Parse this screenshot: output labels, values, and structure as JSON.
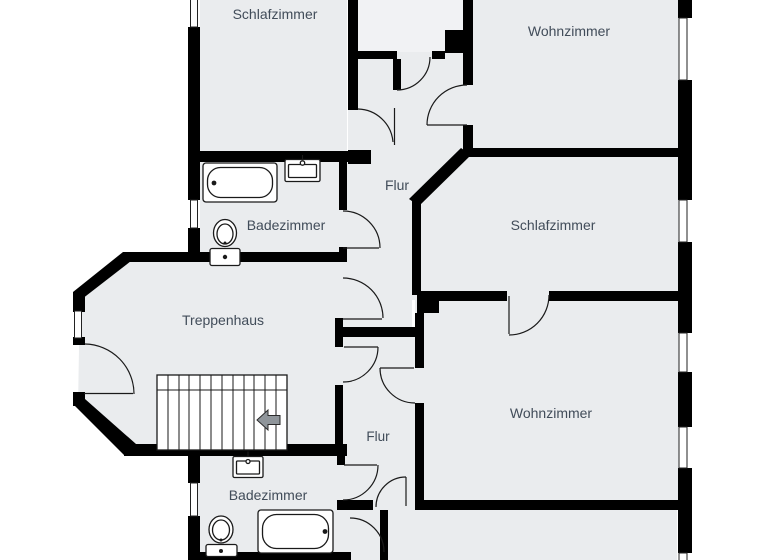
{
  "floorplan": {
    "type": "apartment-floor-plan",
    "rooms": {
      "bedroom_top_left": {
        "label": "Schlafzimmer"
      },
      "living_top_right": {
        "label": "Wohnzimmer"
      },
      "hall_upper": {
        "label": "Flur"
      },
      "bath_upper": {
        "label": "Badezimmer"
      },
      "bedroom_right": {
        "label": "Schlafzimmer"
      },
      "stairwell": {
        "label": "Treppenhaus"
      },
      "living_bottom_right": {
        "label": "Wohnzimmer"
      },
      "hall_lower": {
        "label": "Flur"
      },
      "bath_lower": {
        "label": "Badezimmer"
      }
    },
    "fixtures": {
      "bath_upper": [
        "bathtub",
        "sink",
        "toilet"
      ],
      "bath_lower": [
        "sink",
        "toilet",
        "bathtub"
      ],
      "stairwell": {
        "stairs": true,
        "arrow_direction": "left"
      }
    },
    "colors": {
      "floor": "#eaecee",
      "shaft": "#f1f2f4",
      "wall": "#000000",
      "line": "#1a1a1a",
      "label": "#414c59",
      "arrow_fill": "#8f959a",
      "fixture_fill": "#ffffff"
    }
  }
}
